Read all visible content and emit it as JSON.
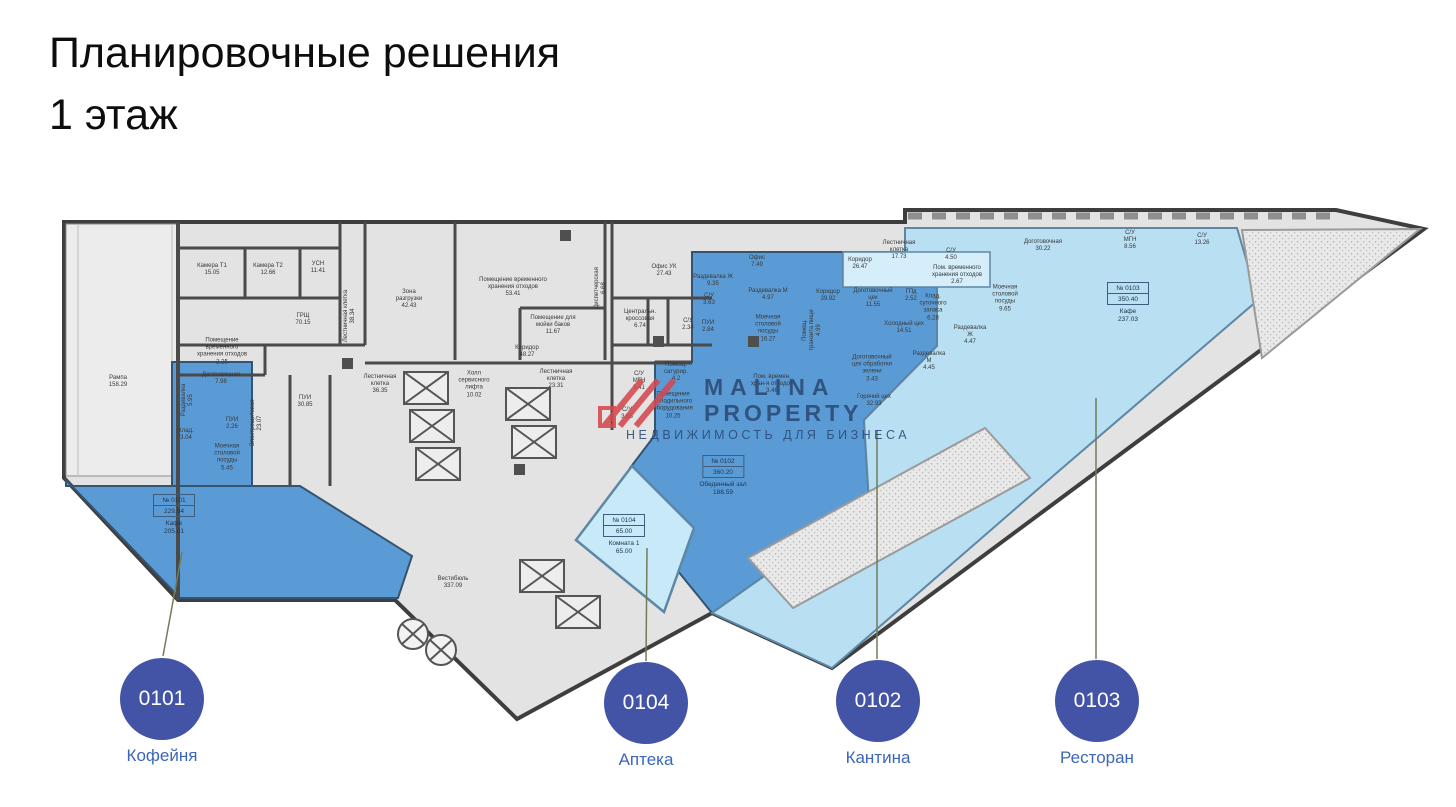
{
  "title": "Планировочные решения\n1 этаж",
  "watermark": {
    "brand_line1": "MALINA",
    "brand_line2": "PROPERTY",
    "tagline": "НЕДВИЖИМОСТЬ ДЛЯ БИЗНЕСА"
  },
  "colors": {
    "unit_dark_blue": "#5b9bd5",
    "unit_light_blue": "#b9dff2",
    "unit_lighter_blue": "#c8e9f8",
    "corridor_light_blue": "#d5eefa",
    "floor_gray": "#e3e3e3",
    "wall_dark": "#3e3e3e",
    "badge_indigo": "#4353a6",
    "badge_label_blue": "#3a67b8",
    "leader_line_olive": "#717d5a",
    "watermark_navy": "#2b4a75",
    "watermark_red": "#d4494e"
  },
  "units": [
    {
      "id": "0101",
      "name": "Кофейня",
      "number_label": "№ 0101",
      "total_area": "229.94",
      "main_room": "Кафе\n205.01",
      "badge": {
        "x": 162,
        "y": 699
      },
      "line": {
        "x1": 182,
        "y1": 552,
        "x2": 163,
        "y2": 656
      },
      "plan_label": {
        "x": 174,
        "y": 494
      }
    },
    {
      "id": "0104",
      "name": "Аптека",
      "number_label": "№ 0104",
      "total_area": "65.00",
      "main_room": "Комната 1\n65.00",
      "badge": {
        "x": 646,
        "y": 703
      },
      "line": {
        "x1": 647,
        "y1": 548,
        "x2": 646,
        "y2": 661
      },
      "plan_label": {
        "x": 624,
        "y": 514
      }
    },
    {
      "id": "0102",
      "name": "Кантина",
      "number_label": "№ 0102",
      "total_area": "360.20",
      "main_room": "Обеденный зал\n188.59",
      "badge": {
        "x": 878,
        "y": 701
      },
      "line": {
        "x1": 877,
        "y1": 430,
        "x2": 877,
        "y2": 659
      },
      "plan_label": {
        "x": 723,
        "y": 455
      }
    },
    {
      "id": "0103",
      "name": "Ресторан",
      "number_label": "№ 0103",
      "total_area": "350.40",
      "main_room": "Кафе\n237.03",
      "badge": {
        "x": 1097,
        "y": 701
      },
      "line": {
        "x1": 1096,
        "y1": 398,
        "x2": 1096,
        "y2": 659
      },
      "plan_label": {
        "x": 1128,
        "y": 282
      }
    }
  ],
  "rooms": [
    {
      "x": 118,
      "y": 382,
      "t": "Рампа\n158.29"
    },
    {
      "x": 212,
      "y": 270,
      "t": "Камера Т1\n15.05"
    },
    {
      "x": 268,
      "y": 270,
      "t": "Камера Т2\n12.66"
    },
    {
      "x": 318,
      "y": 268,
      "t": "УСН\n11.41"
    },
    {
      "x": 303,
      "y": 320,
      "t": "ГРЩ\n70.15"
    },
    {
      "x": 350,
      "y": 316,
      "t": "Лестничная клетка\n38.34",
      "r": 1
    },
    {
      "x": 222,
      "y": 352,
      "t": "Помещение\nвременного\nхранения отходов\n2.25"
    },
    {
      "x": 409,
      "y": 300,
      "t": "Зона\nразгрузки\n42.43"
    },
    {
      "x": 513,
      "y": 288,
      "t": "Помещение временного\nхранения отходов\n53.41"
    },
    {
      "x": 553,
      "y": 326,
      "t": "Помещение для\nмойки баков\n11.67"
    },
    {
      "x": 527,
      "y": 352,
      "t": "Коридор\n48.27"
    },
    {
      "x": 601,
      "y": 288,
      "t": "Диспетчерская\n6.68",
      "r": 1
    },
    {
      "x": 664,
      "y": 271,
      "t": "Офис УК\n27.43"
    },
    {
      "x": 640,
      "y": 320,
      "t": "Центральн.\nкроссовая\n6.74"
    },
    {
      "x": 688,
      "y": 325,
      "t": "С/У\n2.34"
    },
    {
      "x": 380,
      "y": 385,
      "t": "Лестничная\nклетка\n36.35"
    },
    {
      "x": 474,
      "y": 385,
      "t": "Холл\nсервисного\nлифта\n10.02"
    },
    {
      "x": 556,
      "y": 380,
      "t": "Лестничная\nклетка\n23.31"
    },
    {
      "x": 639,
      "y": 382,
      "t": "С/У\nМГН\n5.41"
    },
    {
      "x": 627,
      "y": 414,
      "t": "С/У\n3.65"
    },
    {
      "x": 676,
      "y": 373,
      "t": "Помещ.\nсатурир.\n4.2"
    },
    {
      "x": 673,
      "y": 406,
      "t": "Помещение\nхолодильного\nоборудования\n10.25"
    },
    {
      "x": 257,
      "y": 423,
      "t": "Электрощитовая\n23.07",
      "r": 1
    },
    {
      "x": 305,
      "y": 402,
      "t": "ПУИ\n30.85"
    },
    {
      "x": 453,
      "y": 583,
      "t": "Вестибюль\n337.09"
    },
    {
      "x": 221,
      "y": 379,
      "t": "Доготовочная\n7.98"
    },
    {
      "x": 188,
      "y": 400,
      "t": "Раздевалка\n5.95",
      "r": 1
    },
    {
      "x": 186,
      "y": 435,
      "t": "Клад.\n3.04"
    },
    {
      "x": 232,
      "y": 424,
      "t": "ПУИ\n2.26"
    },
    {
      "x": 227,
      "y": 458,
      "t": "Моечная\nстоловой\nпосуды\n5.45"
    },
    {
      "x": 713,
      "y": 281,
      "t": "Раздевалка Ж\n9.35"
    },
    {
      "x": 709,
      "y": 300,
      "t": "С/У\n3.63"
    },
    {
      "x": 708,
      "y": 327,
      "t": "ПУИ\n2.84"
    },
    {
      "x": 768,
      "y": 295,
      "t": "Раздевалка М\n4.97"
    },
    {
      "x": 757,
      "y": 262,
      "t": "Офис\n7.49"
    },
    {
      "x": 828,
      "y": 296,
      "t": "Коридор\n39.82"
    },
    {
      "x": 768,
      "y": 329,
      "t": "Моечная\nстоловой\nпосуды\n16.27"
    },
    {
      "x": 813,
      "y": 330,
      "t": "Помещ.\nтранзита пищи\n4.99",
      "r": 1
    },
    {
      "x": 772,
      "y": 385,
      "t": "Пом. времен.\nхран-я отходов\n3.46"
    },
    {
      "x": 873,
      "y": 299,
      "t": "Доготовочный\nцех\n11.55"
    },
    {
      "x": 904,
      "y": 328,
      "t": "Холодный цех\n14.51"
    },
    {
      "x": 872,
      "y": 369,
      "t": "Доготовочный\nцех обработки\nзелени\n3.43"
    },
    {
      "x": 874,
      "y": 401,
      "t": "Горячий цех\n32.93"
    },
    {
      "x": 929,
      "y": 362,
      "t": "Раздевалка\nМ\n4.45"
    },
    {
      "x": 860,
      "y": 264,
      "t": "Коридор\n26.47"
    },
    {
      "x": 899,
      "y": 251,
      "t": "Лестничная\nклетка\n17.73"
    },
    {
      "x": 911,
      "y": 296,
      "t": "ГПд\n2.52"
    },
    {
      "x": 933,
      "y": 308,
      "t": "Клад.\nсуточного\nзапаса\n6.28"
    },
    {
      "x": 970,
      "y": 336,
      "t": "Раздевалка\nЖ\n4.47"
    },
    {
      "x": 1043,
      "y": 246,
      "t": "Доготовочная\n30.22"
    },
    {
      "x": 951,
      "y": 255,
      "t": "С/У\n4.50"
    },
    {
      "x": 957,
      "y": 276,
      "t": "Пом. временного\nхранения отходов\n2.67"
    },
    {
      "x": 1005,
      "y": 299,
      "t": "Моечная\nстоловой\nпосуды\n9.65"
    },
    {
      "x": 1130,
      "y": 241,
      "t": "С/У\nМГН\n8.56"
    },
    {
      "x": 1202,
      "y": 240,
      "t": "С/У\n13.26"
    }
  ]
}
